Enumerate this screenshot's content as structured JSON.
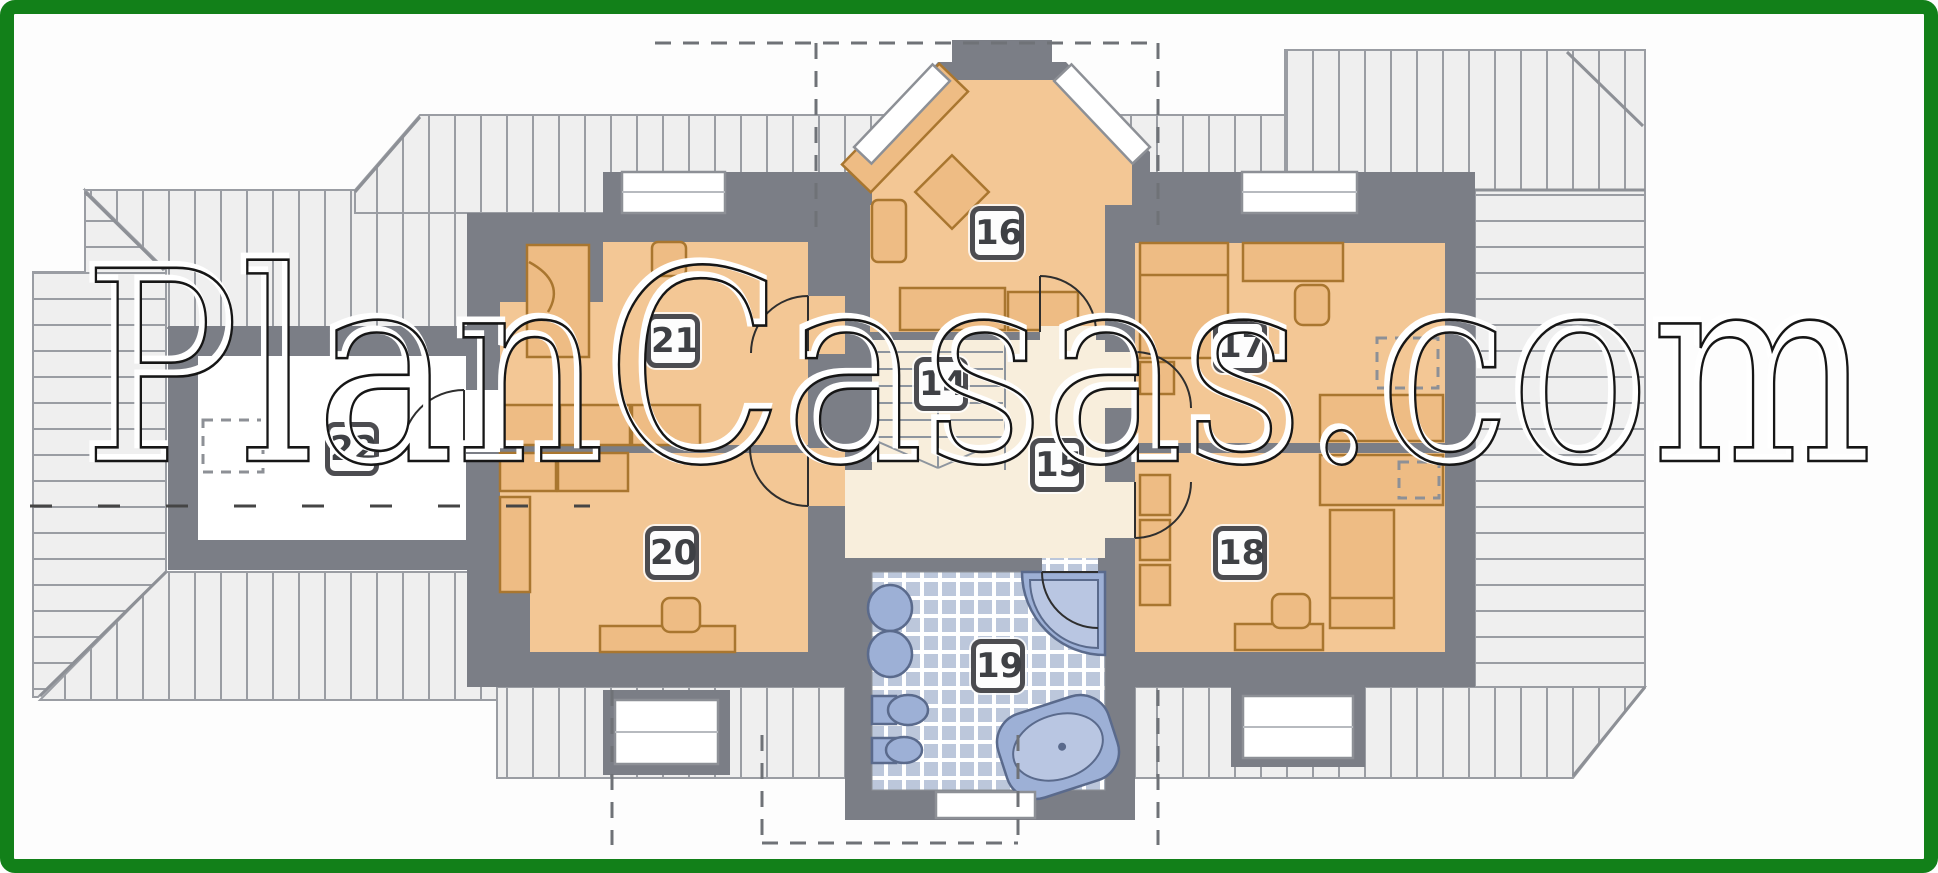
{
  "watermark": {
    "text": "PlanCasas.com"
  },
  "rooms": [
    {
      "number": "14",
      "x": 941,
      "y": 384
    },
    {
      "number": "15",
      "x": 1057,
      "y": 465
    },
    {
      "number": "16",
      "x": 997,
      "y": 233
    },
    {
      "number": "17",
      "x": 1240,
      "y": 346
    },
    {
      "number": "18",
      "x": 1240,
      "y": 553
    },
    {
      "number": "19",
      "x": 998,
      "y": 666
    },
    {
      "number": "20",
      "x": 672,
      "y": 553
    },
    {
      "number": "21",
      "x": 673,
      "y": 341
    },
    {
      "number": "22",
      "x": 352,
      "y": 449
    }
  ],
  "colors": {
    "border_green": "#128019",
    "wall_gray": "#7b7e86",
    "floor_tan": "#f3c795",
    "hall_cream": "#f8eedc",
    "furniture_tan": "#eebc84",
    "furniture_line": "#a9762f",
    "bath_tile_blue": "#bcc7db",
    "fixture_blue": "#9db0d6",
    "roof_gray": "#efefef"
  }
}
